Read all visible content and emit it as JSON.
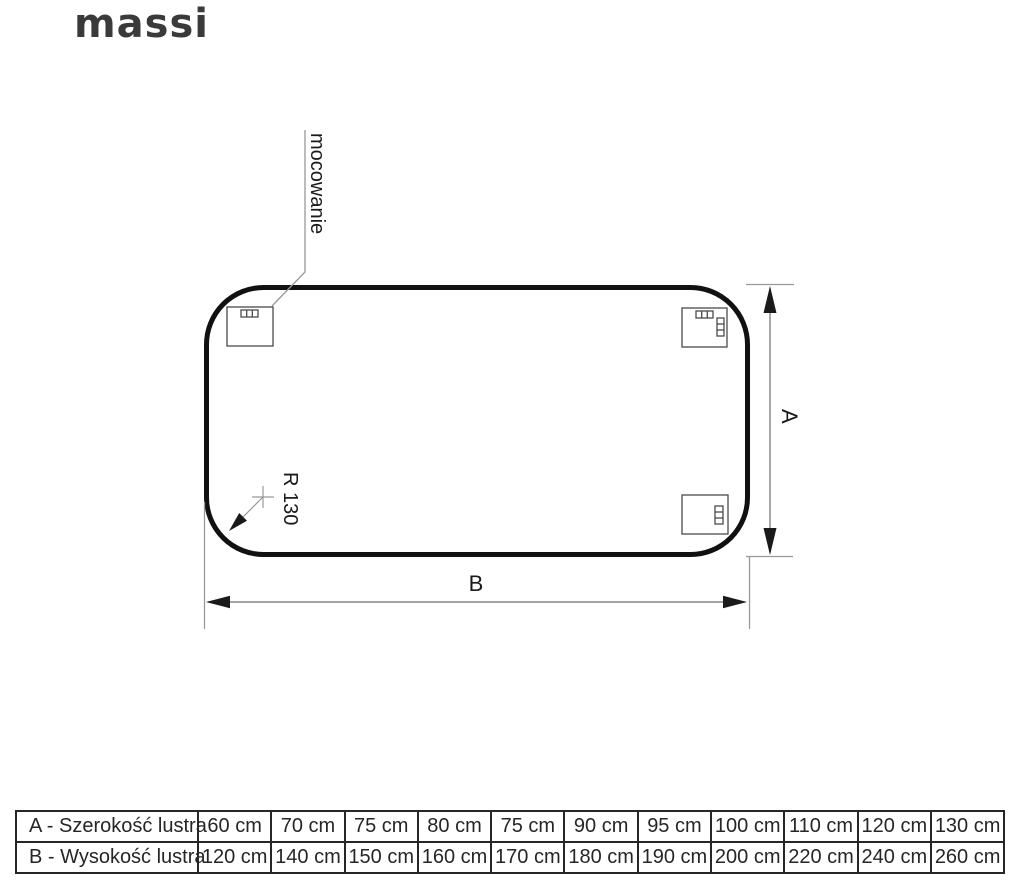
{
  "brand": {
    "logo_text": "massi"
  },
  "diagram": {
    "mounting_label": "mocowanie",
    "radius_label": "R 130",
    "dim_height_label": "A",
    "dim_width_label": "B"
  },
  "colors": {
    "mirror_outline": "#111111",
    "bracket_line": "#4a4a4a",
    "thin_line": "#999999",
    "dim_line": "#6e6e6e",
    "arrow_fill": "#1a1a1a",
    "table_border": "#262626",
    "logo": "#3a3a3a"
  },
  "table": {
    "rows": [
      {
        "label": "A - Szerokość lustra",
        "values": [
          "60 cm",
          "70 cm",
          "75 cm",
          "80 cm",
          "75 cm",
          "90 cm",
          "95 cm",
          "100 cm",
          "110 cm",
          "120 cm",
          "130 cm"
        ]
      },
      {
        "label": "B - Wysokość lustra",
        "values": [
          "120 cm",
          "140 cm",
          "150 cm",
          "160 cm",
          "170 cm",
          "180 cm",
          "190 cm",
          "200 cm",
          "220 cm",
          "240 cm",
          "260 cm"
        ]
      }
    ]
  }
}
